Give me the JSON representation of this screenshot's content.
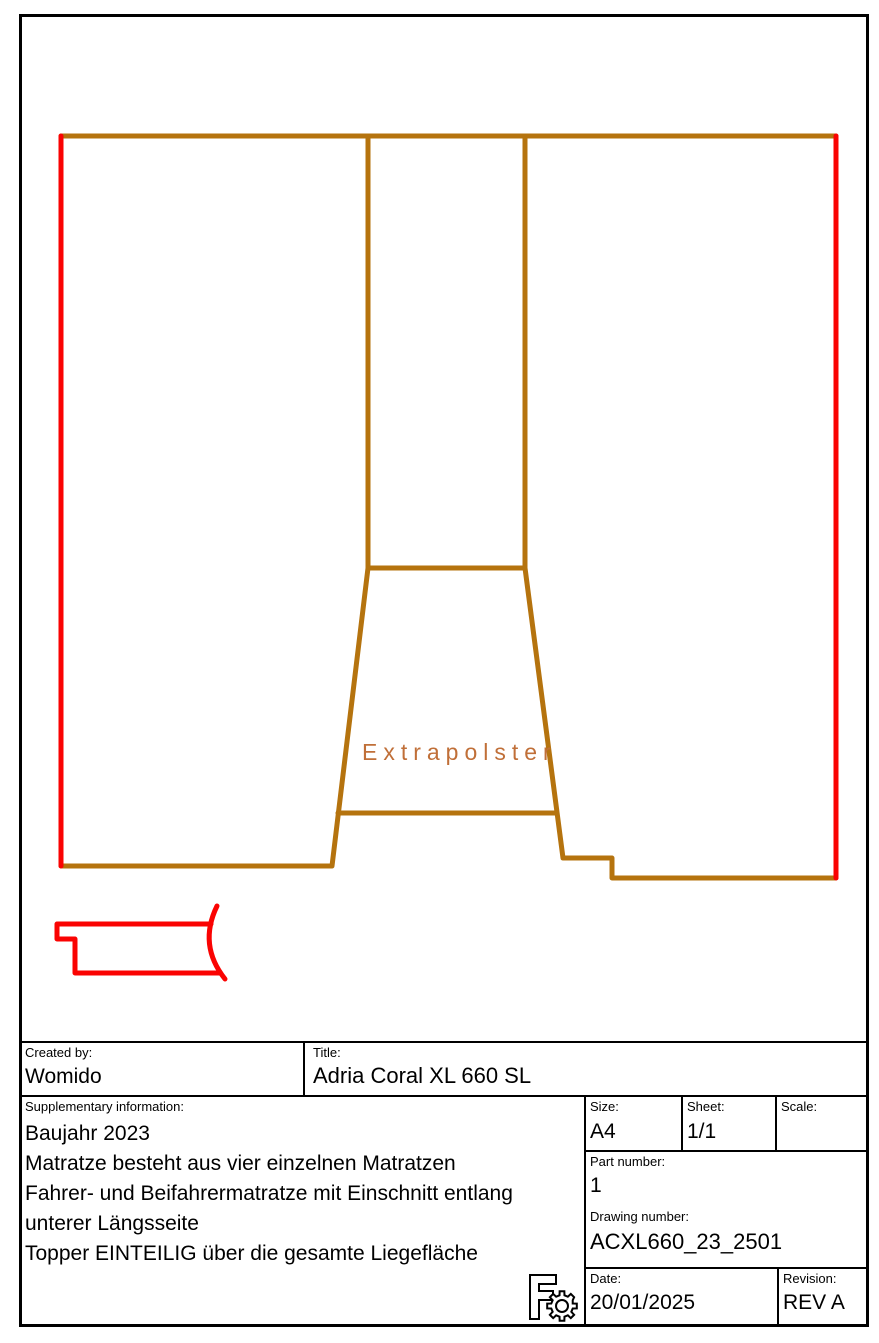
{
  "colors": {
    "red": "#fa0302",
    "brown": "#b5730e",
    "extrapolster_text": "#c06f38",
    "border_black": "#000000"
  },
  "drawing": {
    "extrapolster_label": "Extrapolster"
  },
  "title_block": {
    "created_by": {
      "label": "Created by:",
      "value": "Womido"
    },
    "title": {
      "label": "Title:",
      "value": "Adria Coral XL 660 SL"
    },
    "supplementary": {
      "label": "Supplementary information:",
      "lines": [
        "Baujahr 2023",
        "Matratze besteht aus vier einzelnen Matratzen",
        "Fahrer- und Beifahrermatratze mit Einschnitt entlang",
        "unterer Längsseite",
        "Topper EINTEILIG über die gesamte Liegefläche"
      ]
    },
    "size": {
      "label": "Size:",
      "value": "A4"
    },
    "sheet": {
      "label": "Sheet:",
      "value": "1/1"
    },
    "scale": {
      "label": "Scale:",
      "value": ""
    },
    "part_number": {
      "label": "Part number:",
      "value": "1"
    },
    "drawing_number": {
      "label": "Drawing number:",
      "value": "ACXL660_23_2501"
    },
    "date": {
      "label": "Date:",
      "value": "20/01/2025"
    },
    "revision": {
      "label": "Revision:",
      "value": "REV A"
    }
  }
}
